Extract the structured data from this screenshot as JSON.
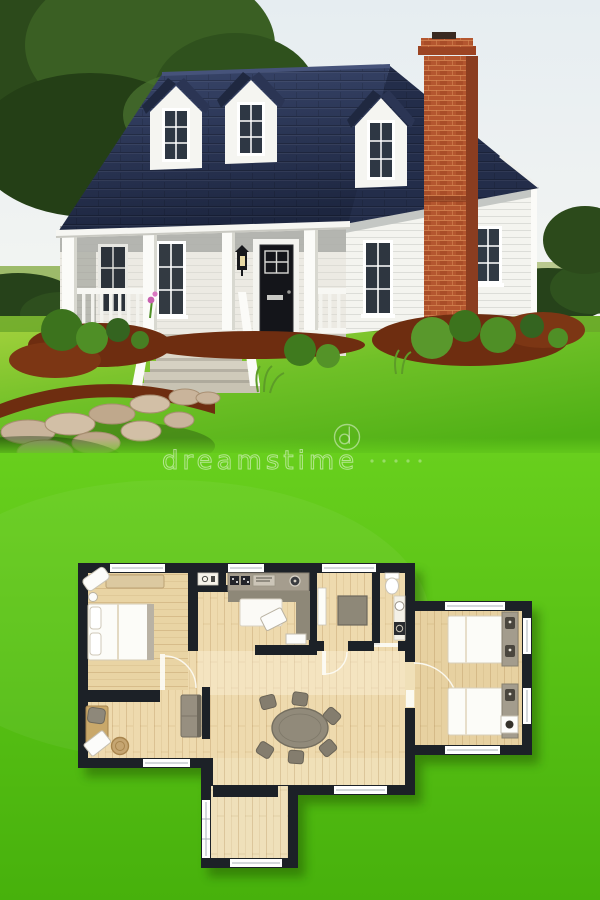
{
  "image": {
    "type": "stock-photo-composite",
    "title": "White cottage exterior photo above a 2D floor plan rendered on green lawn"
  },
  "watermark": {
    "text": "dreamstime",
    "logo": "dreamstime-circle-logo",
    "color": "#ffffff",
    "opacity": 0.5
  },
  "photo": {
    "subject": "small white cottage with navy roof, three dormers, brick chimney, front porch",
    "sky_color": "#e9eff2",
    "tree_color": "#33571f",
    "lawn_color": "#58b61c",
    "mulch_color": "#6e2d10",
    "path_color": "#c9b49b",
    "house": {
      "siding_color": "#f7f7f3",
      "roof_color": "#273150",
      "chimney_brick_color": "#b4562f",
      "front_door_color": "#14151a",
      "dormer_count": 3,
      "porch_features": [
        "white columns",
        "white railing with balusters",
        "front steps",
        "wall lantern",
        "black front door",
        "six-pane windows"
      ],
      "landscaping": [
        "bright green lawn",
        "shrubs",
        "red mulch beds",
        "stone walkway",
        "large trees",
        "hedges"
      ]
    }
  },
  "floor_plan": {
    "background_color": "#5ac413",
    "wall_color": "#1c2127",
    "floor_color": "#eedaae",
    "window_color": "#ffffff",
    "furniture_gray": "#8e8878",
    "rooms": [
      {
        "name": "bedroom-left",
        "furniture": [
          "double bed with two pillows",
          "bench",
          "bedside lamp",
          "corner chaise"
        ]
      },
      {
        "name": "office-sitting-room",
        "furniture": [
          "desk",
          "round chair",
          "small sofa",
          "laptop",
          "basket"
        ]
      },
      {
        "name": "kitchen-lounge",
        "furniture": [
          "counter with cooktop and sink",
          "sectional sofa with white cushion",
          "angled coffee table",
          "side table"
        ]
      },
      {
        "name": "study",
        "furniture": [
          "square table",
          "open door leaf"
        ]
      },
      {
        "name": "bathroom",
        "furniture": [
          "toilet",
          "sink counter",
          "washer"
        ]
      },
      {
        "name": "living-dining",
        "furniture": [
          "oval dining table",
          "six chairs"
        ]
      },
      {
        "name": "bedroom-right-wing",
        "furniture": [
          "two single beds with gray headboards",
          "white nightstand"
        ]
      },
      {
        "name": "entry-porch",
        "furniture": []
      }
    ],
    "window_count": 10,
    "door_arc_count": 3
  }
}
